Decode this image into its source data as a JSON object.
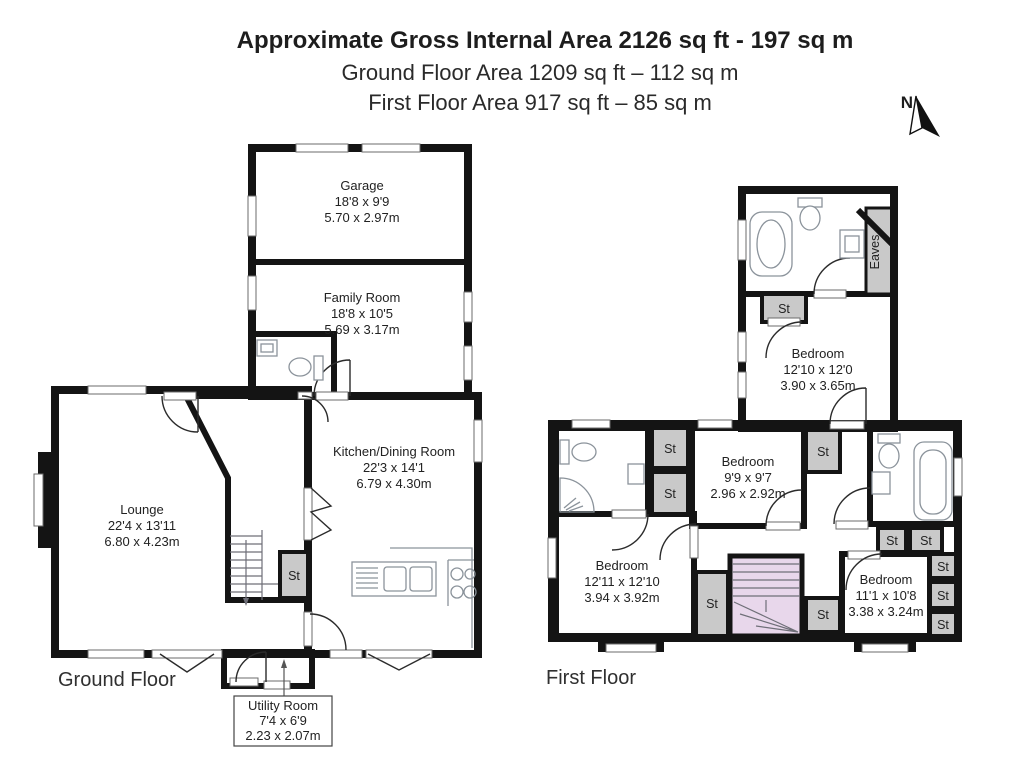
{
  "header": {
    "title": "Approximate Gross Internal Area 2126 sq ft - 197 sq m",
    "ground_area": "Ground Floor Area 1209 sq ft – 112 sq m",
    "first_area": "First Floor Area 917 sq ft – 85 sq m"
  },
  "compass": {
    "north": "N"
  },
  "labels": {
    "storage": "St",
    "eaves": "Eaves"
  },
  "ground_floor": {
    "label": "Ground Floor",
    "rooms": {
      "garage": {
        "name": "Garage",
        "imperial": "18'8 x 9'9",
        "metric": "5.70 x 2.97m"
      },
      "family_room": {
        "name": "Family Room",
        "imperial": "18'8 x 10'5",
        "metric": "5.69 x 3.17m"
      },
      "kitchen_dining": {
        "name": "Kitchen/Dining Room",
        "imperial": "22'3 x 14'1",
        "metric": "6.79 x 4.30m"
      },
      "lounge": {
        "name": "Lounge",
        "imperial": "22'4 x 13'11",
        "metric": "6.80 x 4.23m"
      },
      "utility_room": {
        "name": "Utility Room",
        "imperial": "7'4 x 6'9",
        "metric": "2.23 x 2.07m"
      }
    }
  },
  "first_floor": {
    "label": "First Floor",
    "rooms": {
      "bedroom_1": {
        "name": "Bedroom",
        "imperial": "12'10 x 12'0",
        "metric": "3.90 x 3.65m"
      },
      "bedroom_2": {
        "name": "Bedroom",
        "imperial": "9'9 x 9'7",
        "metric": "2.96 x 2.92m"
      },
      "bedroom_3": {
        "name": "Bedroom",
        "imperial": "12'11 x 12'10",
        "metric": "3.94 x 3.92m"
      },
      "bedroom_4": {
        "name": "Bedroom",
        "imperial": "11'1 x 10'8",
        "metric": "3.38 x 3.24m"
      }
    }
  },
  "colors": {
    "wall": "#141414",
    "room_cream": "#F2EDCB",
    "room_peach": "#F8D5B6",
    "room_blue": "#DDE9EF",
    "room_gray": "#C9C9C9",
    "hall_lilac": "#E8D7EB"
  }
}
